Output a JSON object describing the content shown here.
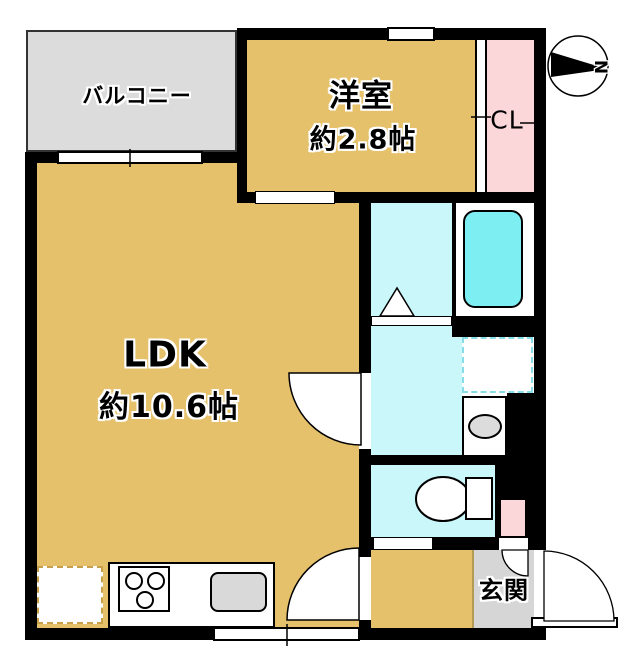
{
  "rooms": {
    "balcony": {
      "label": "バルコニー"
    },
    "western_room": {
      "label": "洋室",
      "size": "約2.8帖"
    },
    "closet": {
      "label": "CL"
    },
    "ldk": {
      "label": "LDK",
      "size": "約10.6帖"
    },
    "entrance": {
      "label": "玄関"
    }
  },
  "compass": {
    "north_label": "N"
  },
  "colors": {
    "room_floor": "#e6c16c",
    "balcony_floor": "#dcdcdc",
    "entrance_floor": "#d6d6d6",
    "closet_pink": "#fbd7da",
    "wet_area": "#c9f7fa",
    "bathtub": "#7deef2",
    "fixture_gray": "#d9d9d9",
    "wall": "#000000"
  },
  "icons": [
    "north-arrow-icon",
    "bathtub-icon",
    "toilet-icon",
    "washbasin-icon",
    "washing-machine-icon",
    "refrigerator-icon",
    "stove-icon",
    "sink-icon",
    "door-swing-icon",
    "window-icon",
    "folding-door-icon"
  ]
}
